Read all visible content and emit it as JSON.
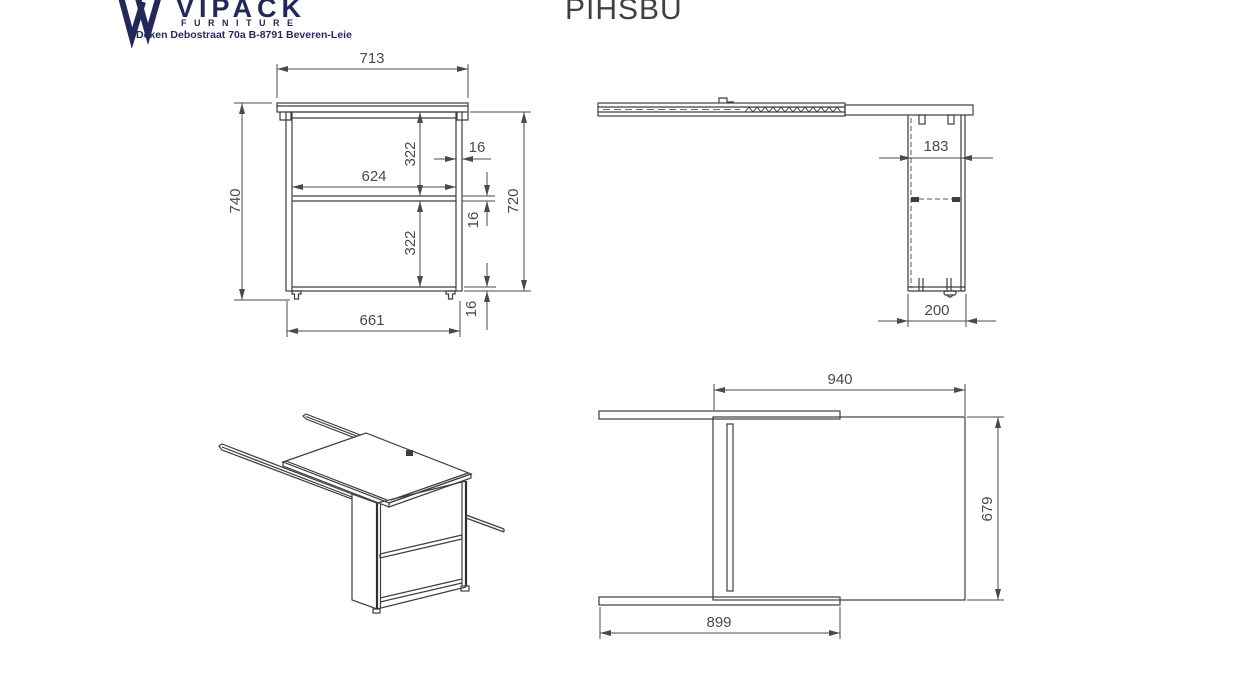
{
  "header": {
    "brand": {
      "name": "VIPACK",
      "tagline": "FURNITURE",
      "address": "Deken Debostraat 70a B-8791 Beveren-Leie",
      "color": "#23285a"
    },
    "product_code": "PIHSBU"
  },
  "drawing": {
    "line_color": "#3e3e3e",
    "dimension_color": "#4a4a4a",
    "views": {
      "front": {
        "title": "front view",
        "dimensions": {
          "top_overall_width": "713",
          "left_overall_height": "740",
          "inner_width": "624",
          "upper_compartment_height": "322",
          "side_panel_thickness": "16",
          "lower_compartment_height": "322",
          "shelf_thickness": "16",
          "right_overall_height": "720",
          "body_width": "661",
          "bottom_panel_thickness": "16"
        }
      },
      "side": {
        "title": "side view",
        "dimensions": {
          "inner_depth": "183",
          "base_depth": "200"
        }
      },
      "plan": {
        "title": "top view",
        "dimensions": {
          "desk_top_width": "940",
          "desk_depth": "679",
          "rail_length": "899"
        }
      },
      "isometric": {
        "title": "isometric view"
      }
    }
  }
}
